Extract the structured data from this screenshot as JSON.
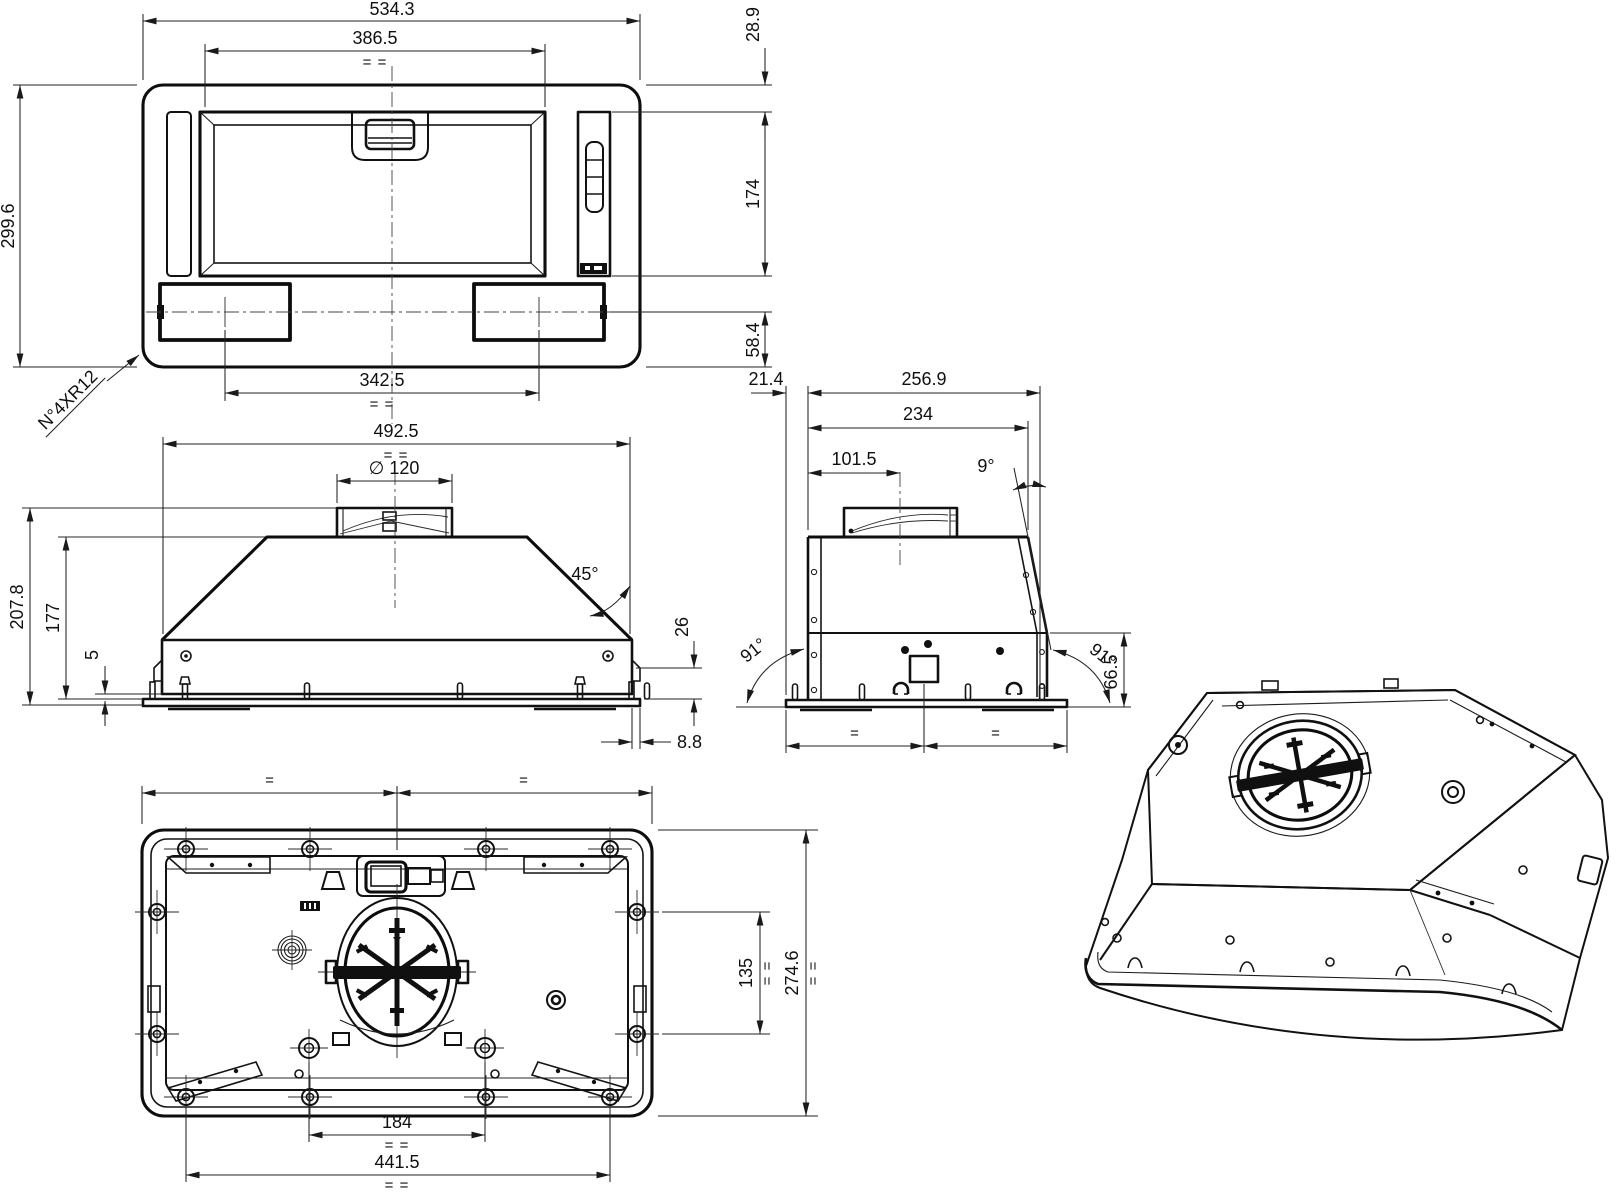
{
  "drawing": {
    "kind": "cooker-hood multi-view dimension drawing",
    "colors": {
      "line": "#111111",
      "background": "#ffffff"
    }
  },
  "symbols": {
    "eq_pair": "= =",
    "eq_single": "="
  },
  "plan_view": {
    "width_total": "534.3",
    "width_inner": "386.5",
    "height_total": "299.6",
    "offset_top": "28.9",
    "height_panel": "174",
    "offset_lamp": "58.4",
    "lamp_spacing": "342.5",
    "corner_note": "N°4XR12"
  },
  "front_view": {
    "width_body": "492.5",
    "duct_diameter": "∅ 120",
    "slope_angle": "45°",
    "height_total": "207.8",
    "height_body": "177",
    "gap_flange": "5",
    "height_edge": "26",
    "flange_overhang": "8.8"
  },
  "side_view": {
    "front_overhang": "21.4",
    "depth_total": "256.9",
    "depth_body": "234",
    "duct_center": "101.5",
    "tilt_angle": "9°",
    "angle_left": "91°",
    "angle_right": "91°",
    "height_band": "66.5"
  },
  "bottom_view": {
    "screw_span_depth": "135",
    "depth_total": "274.6",
    "hole_spacing": "184",
    "screw_span_width": "441.5"
  }
}
